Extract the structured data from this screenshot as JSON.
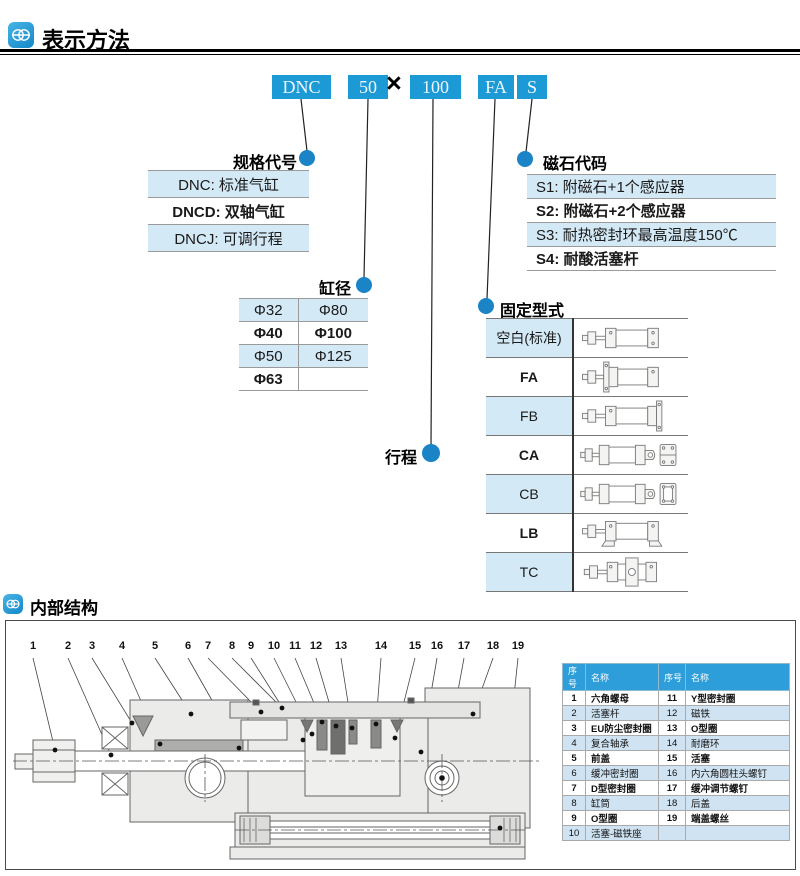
{
  "colors": {
    "accent_blue": "#1b9ad6",
    "dot_blue": "#1a84c6",
    "row_blue": "#d4e9f6",
    "parts_header_blue": "#2d9ed9"
  },
  "header": {
    "title": "表示方法"
  },
  "order_code": {
    "model": "DNC",
    "bore": "50",
    "multiply": "×",
    "stroke": "100",
    "mount": "FA",
    "magnet": "S"
  },
  "spec_table": {
    "label": "规格代号",
    "rows": [
      "DNC: 标准气缸",
      "DNCD: 双轴气缸",
      "DNCJ: 可调行程"
    ]
  },
  "magnet_table": {
    "label": "磁石代码",
    "rows": [
      "S1: 附磁石+1个感应器",
      "S2: 附磁石+2个感应器",
      "S3: 耐热密封环最高温度150℃",
      "S4: 耐酸活塞杆"
    ]
  },
  "bore_table": {
    "label": "缸径",
    "rows": [
      [
        "Φ32",
        "Φ80"
      ],
      [
        "Φ40",
        "Φ100"
      ],
      [
        "Φ50",
        "Φ125"
      ],
      [
        "Φ63",
        ""
      ]
    ]
  },
  "stroke_label": {
    "label": "行程"
  },
  "mounting_table": {
    "label": "固定型式",
    "rows": [
      "空白(标准)",
      "FA",
      "FB",
      "CA",
      "CB",
      "LB",
      "TC"
    ]
  },
  "internal": {
    "title": "内部结构",
    "callouts": [
      "1",
      "2",
      "3",
      "4",
      "5",
      "6",
      "7",
      "8",
      "9",
      "10",
      "11",
      "12",
      "13",
      "14",
      "15",
      "16",
      "17",
      "18",
      "19"
    ],
    "parts_table": {
      "headers": [
        "序号",
        "名称",
        "序号",
        "名称"
      ],
      "rows": [
        [
          "1",
          "六角螺母",
          "11",
          "Y型密封圈"
        ],
        [
          "2",
          "活塞杆",
          "12",
          "磁铁"
        ],
        [
          "3",
          "EU防尘密封圈",
          "13",
          "O型圈"
        ],
        [
          "4",
          "复合轴承",
          "14",
          "耐磨环"
        ],
        [
          "5",
          "前盖",
          "15",
          "活塞"
        ],
        [
          "6",
          "缓冲密封圈",
          "16",
          "内六角圆柱头螺钉"
        ],
        [
          "7",
          "D型密封圈",
          "17",
          "缓冲调节螺钉"
        ],
        [
          "8",
          "缸筒",
          "18",
          "后盖"
        ],
        [
          "9",
          "O型圈",
          "19",
          "端盖螺丝"
        ],
        [
          "10",
          "活塞-磁铁座",
          "",
          ""
        ]
      ]
    }
  }
}
